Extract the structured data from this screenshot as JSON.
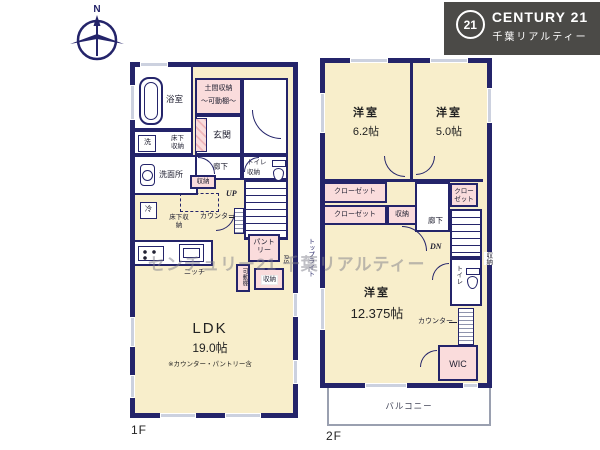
{
  "brand": {
    "badge_number": "21",
    "name": "CENTURY 21",
    "subtitle": "千葉リアルティー"
  },
  "compass": {
    "north_label": "N"
  },
  "watermark_text": "センチュリー21 千葉リアルティー",
  "floor1": {
    "floor_label": "1F",
    "bathroom": "浴室",
    "washer": "洗",
    "underfloor_storage_a": "床下収納",
    "washroom": "洗面所",
    "doma_storage": "土間収納",
    "doma_shelf": "～可動棚～",
    "entrance": "玄関",
    "hallway": "廊下",
    "toilet": "トイレ",
    "toilet_storage": "収納",
    "hall_storage": "収納",
    "fridge": "冷",
    "counter_label": "カウンター",
    "underfloor_storage_b": "床下収納",
    "stairs_up": "UP",
    "niche": "ニッチ",
    "pantry": "パントリー",
    "pantry_shelf": "可動棚",
    "pantry_storage": "収納",
    "pipe_space": "PS",
    "ldk_name": "LDK",
    "ldk_size": "19.0帖",
    "ldk_note": "※カウンター・パントリー含"
  },
  "floor2": {
    "floor_label": "2F",
    "bedroom1_name": "洋室",
    "bedroom1_size": "6.2帖",
    "bedroom2_name": "洋室",
    "bedroom2_size": "5.0帖",
    "closet_a": "クローゼット",
    "closet_b": "クローゼット",
    "closet_c": "クローゼット",
    "center_storage": "収納",
    "hallway": "廊下",
    "stairs_down": "DN",
    "toilet": "トイレ",
    "side_storage": "収納",
    "counter_label": "カウンター",
    "bedroom3_name": "洋室",
    "bedroom3_size": "12.375帖",
    "wic": "WIC",
    "skylight": "トップライト",
    "balcony": "バルコニー"
  }
}
